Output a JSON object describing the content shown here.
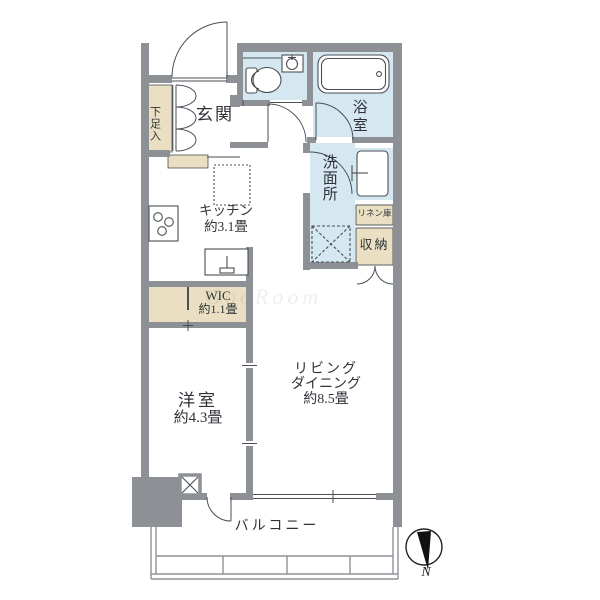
{
  "floorplan": {
    "rooms": {
      "shoe_cabinet": {
        "label": "下足入"
      },
      "genkan": {
        "label": "玄関"
      },
      "bathroom": {
        "label": "浴室"
      },
      "washroom": {
        "label": "洗面所"
      },
      "kitchen": {
        "label": "キッチン",
        "size": "約3.1畳"
      },
      "linen_closet": {
        "label": "リネン庫"
      },
      "storage": {
        "label": "収納"
      },
      "wic": {
        "label": "WIC",
        "size": "約1.1畳"
      },
      "western_room": {
        "label": "洋室",
        "size": "約4.3畳"
      },
      "living_dining": {
        "label_line1": "リビング",
        "label_line2": "ダイニング",
        "size": "約8.5畳"
      },
      "balcony": {
        "label": "バルコニー"
      }
    },
    "compass": {
      "north_label": "N"
    },
    "watermark": "GooRoom",
    "colors": {
      "wall": "#8d9196",
      "water": "#d5e7f1",
      "beige": "#eadfc2",
      "line": "#4a4f55",
      "rail": "#8d9196"
    }
  }
}
